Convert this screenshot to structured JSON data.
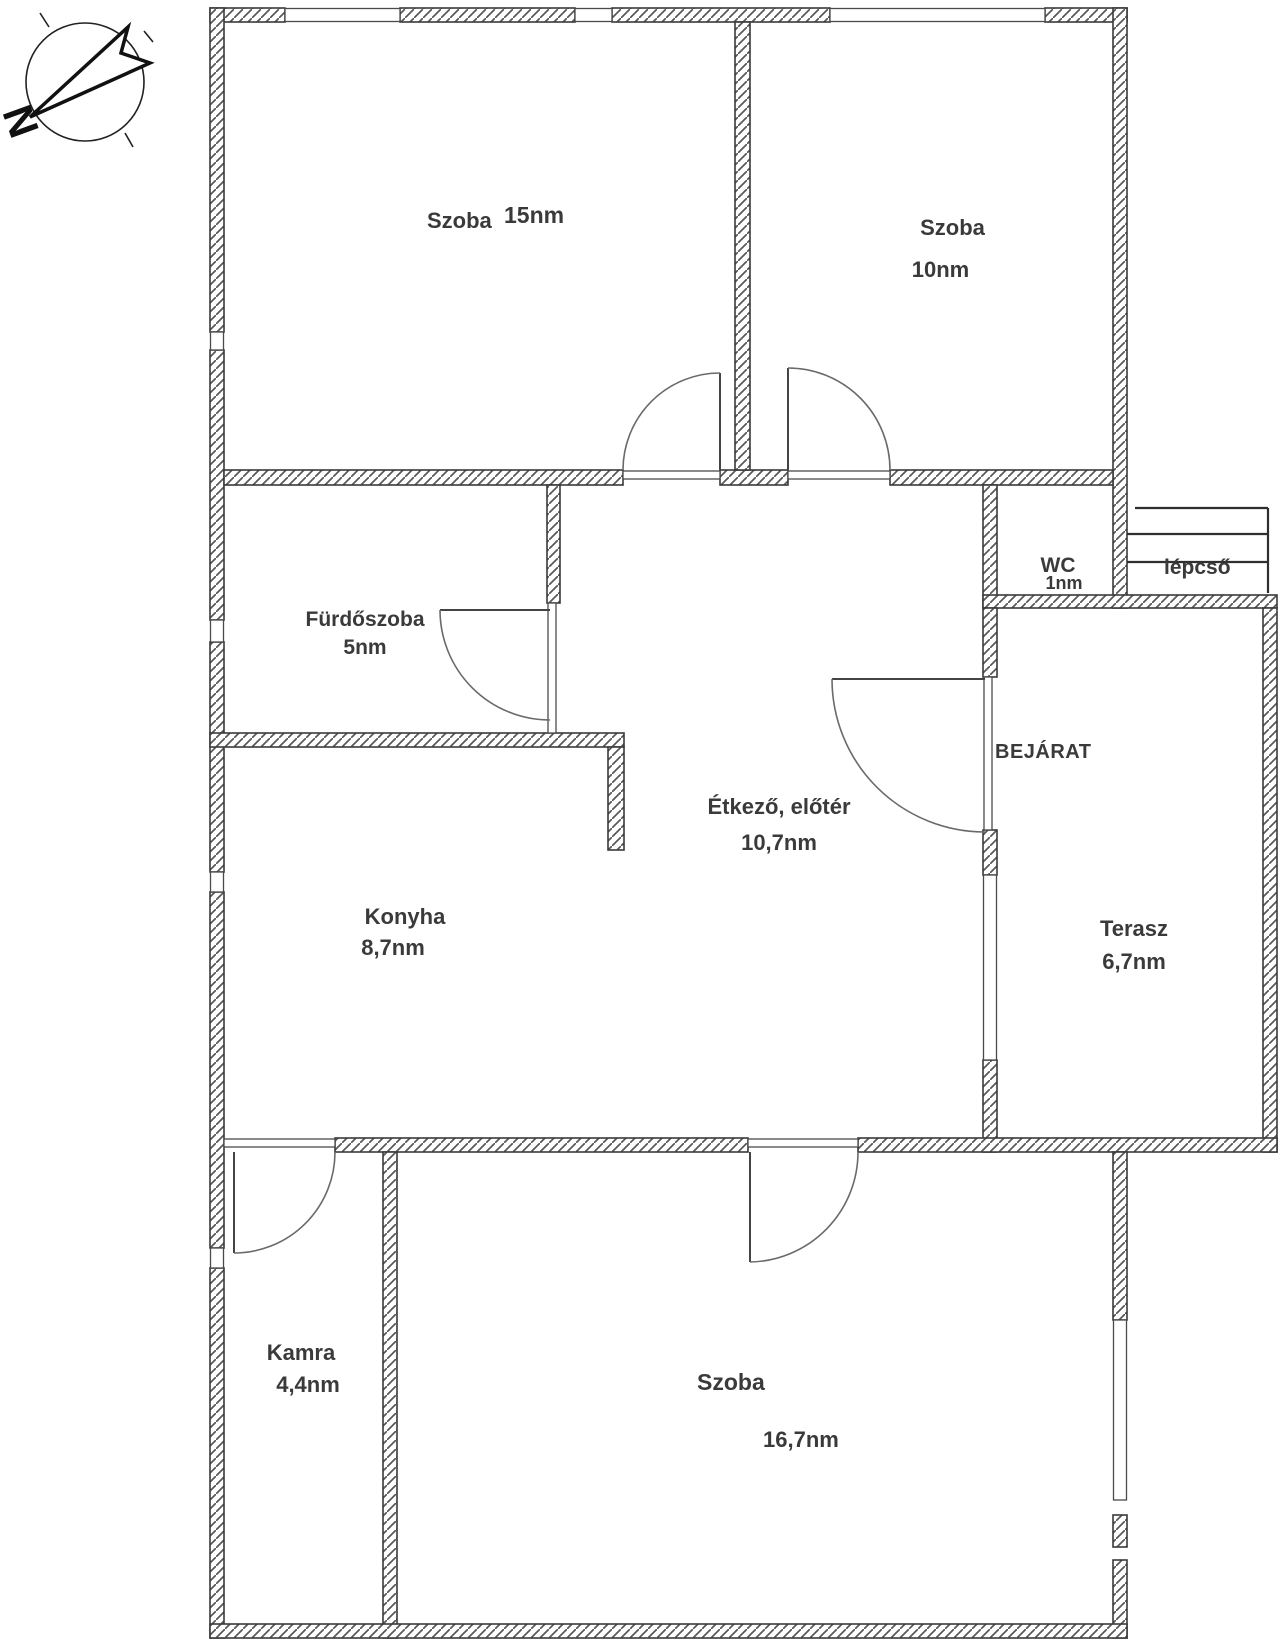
{
  "floor_plan": {
    "rooms": {
      "szoba15": {
        "name": "Szoba",
        "area": "15nm"
      },
      "szoba10": {
        "name": "Szoba",
        "area": "10nm"
      },
      "furdoszoba": {
        "name": "Fürdőszoba",
        "area": "5nm"
      },
      "wc": {
        "name": "WC",
        "area": "1nm"
      },
      "etkezo_eloter": {
        "name": "Étkező, előtér",
        "area": "10,7nm"
      },
      "konyha": {
        "name": "Konyha",
        "area": "8,7nm"
      },
      "terasz": {
        "name": "Terasz",
        "area": "6,7nm"
      },
      "kamra": {
        "name": "Kamra",
        "area": "4,4nm"
      },
      "szoba_nagy": {
        "name": "Szoba",
        "area": "16,7nm"
      }
    },
    "labels": {
      "bejarat": "BEJÁRAT",
      "lepcso": "lépcső"
    },
    "compass": {
      "north": "N"
    },
    "colors": {
      "background": "#ffffff",
      "wall_outline": "#3a3a3a",
      "hatch": "#575757",
      "text": "#3a3a3a",
      "thin_line": "#6a6a6a"
    }
  }
}
